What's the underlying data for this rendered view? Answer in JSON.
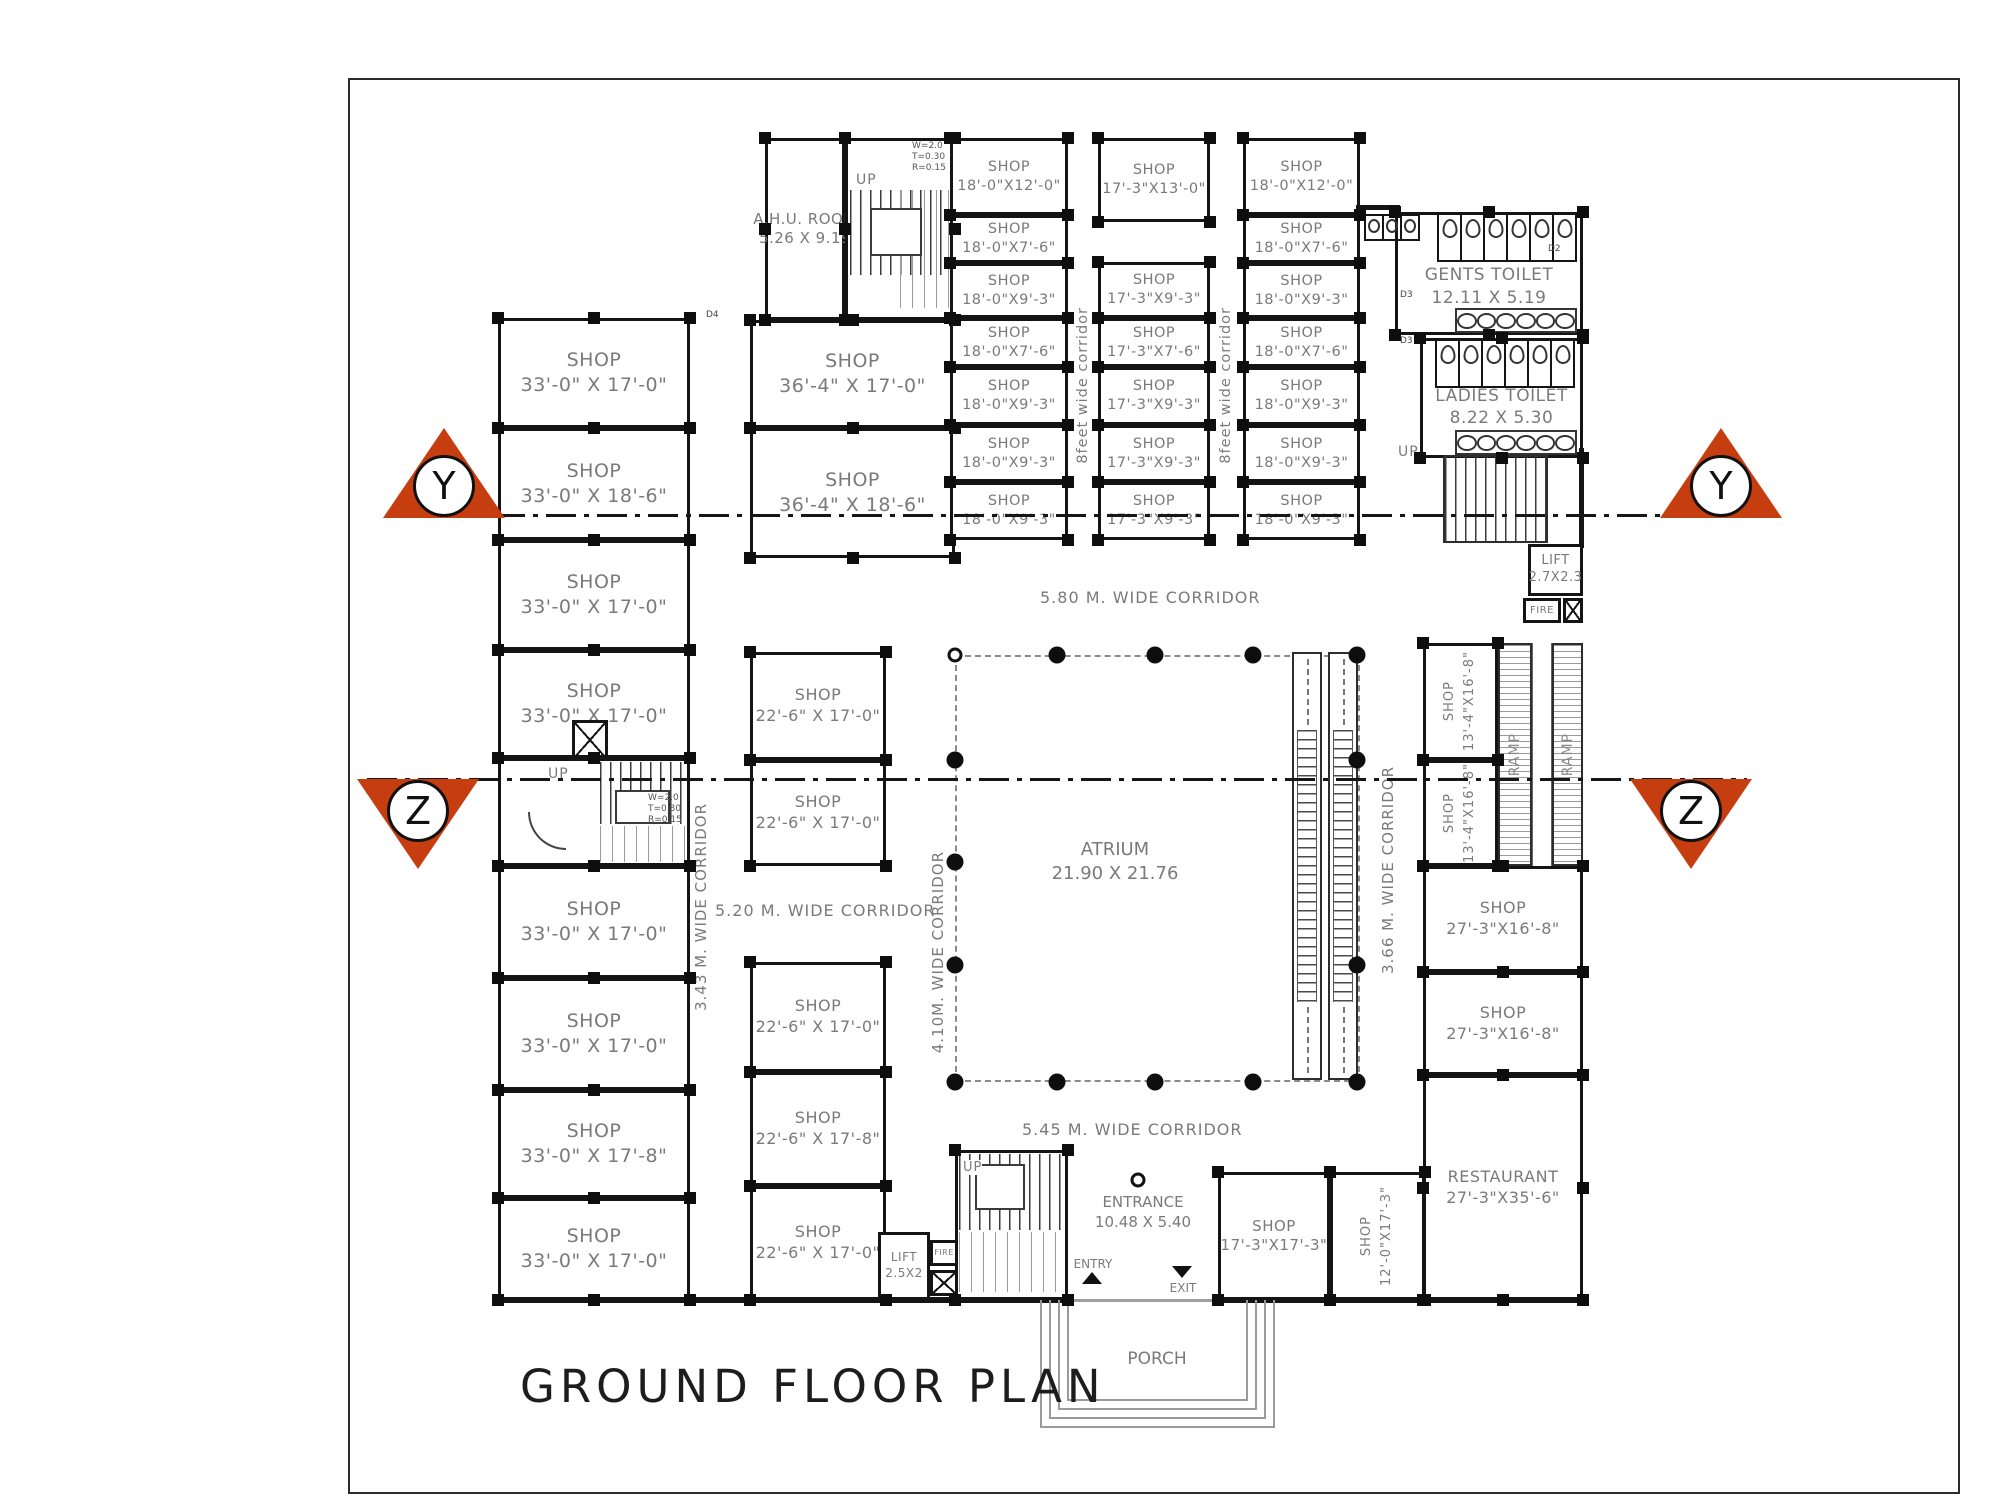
{
  "title": "GROUND FLOOR PLAN",
  "shops": {
    "left": [
      {
        "name": "SHOP",
        "dims": "33'-0\" X 17'-0\""
      },
      {
        "name": "SHOP",
        "dims": "33'-0\" X 18'-6\""
      },
      {
        "name": "SHOP",
        "dims": "33'-0\" X 17'-0\""
      },
      {
        "name": "SHOP",
        "dims": "33'-0\" X 17'-0\""
      },
      {
        "name": "SHOP",
        "dims": "33'-0\" X 17'-0\""
      },
      {
        "name": "SHOP",
        "dims": "33'-0\" X 17'-0\""
      },
      {
        "name": "SHOP",
        "dims": "33'-0\" X 17'-8\""
      },
      {
        "name": "SHOP",
        "dims": "33'-0\" X 17'-0\""
      }
    ],
    "mid22": [
      {
        "name": "SHOP",
        "dims": "22'-6\" X 17'-0\""
      },
      {
        "name": "SHOP",
        "dims": "22'-6\" X 17'-0\""
      },
      {
        "name": "SHOP",
        "dims": "22'-6\" X 17'-0\""
      },
      {
        "name": "SHOP",
        "dims": "22'-6\" X 17'-8\""
      },
      {
        "name": "SHOP",
        "dims": "22'-6\" X 17'-0\""
      }
    ],
    "wide36": [
      {
        "name": "SHOP",
        "dims": "36'-4\" X 17'-0\""
      },
      {
        "name": "SHOP",
        "dims": "36'-4\" X 18'-6\""
      }
    ],
    "col18_left": [
      {
        "name": "SHOP",
        "dims": "18'-0\"X12'-0\""
      },
      {
        "name": "SHOP",
        "dims": "18'-0\"X7'-6\""
      },
      {
        "name": "SHOP",
        "dims": "18'-0\"X9'-3\""
      },
      {
        "name": "SHOP",
        "dims": "18'-0\"X7'-6\""
      },
      {
        "name": "SHOP",
        "dims": "18'-0\"X9'-3\""
      },
      {
        "name": "SHOP",
        "dims": "18'-0\"X9'-3\""
      },
      {
        "name": "SHOP",
        "dims": "18'-0\"X9'-3\""
      }
    ],
    "col17": [
      {
        "name": "SHOP",
        "dims": "17'-3\"X13'-0\""
      },
      {
        "name": "SHOP",
        "dims": "17'-3\"X9'-3\""
      },
      {
        "name": "SHOP",
        "dims": "17'-3\"X7'-6\""
      },
      {
        "name": "SHOP",
        "dims": "17'-3\"X9'-3\""
      },
      {
        "name": "SHOP",
        "dims": "17'-3\"X9'-3\""
      },
      {
        "name": "SHOP",
        "dims": "17'-3\"X9'-3\""
      }
    ],
    "col18_right": [
      {
        "name": "SHOP",
        "dims": "18'-0\"X12'-0\""
      },
      {
        "name": "SHOP",
        "dims": "18'-0\"X7'-6\""
      },
      {
        "name": "SHOP",
        "dims": "18'-0\"X9'-3\""
      },
      {
        "name": "SHOP",
        "dims": "18'-0\"X7'-6\""
      },
      {
        "name": "SHOP",
        "dims": "18'-0\"X9'-3\""
      },
      {
        "name": "SHOP",
        "dims": "18'-0\"X9'-3\""
      },
      {
        "name": "SHOP",
        "dims": "18'-0\"X9'-3\""
      }
    ],
    "right_vertical": [
      {
        "name": "SHOP",
        "dims": "13'-4\"X16'-8\""
      },
      {
        "name": "SHOP",
        "dims": "13'-4\"X16'-8\""
      }
    ],
    "right27": [
      {
        "name": "SHOP",
        "dims": "27'-3\"X16'-8\""
      },
      {
        "name": "SHOP",
        "dims": "27'-3\"X16'-8\""
      }
    ],
    "bottom": [
      {
        "name": "SHOP",
        "dims": "17'-3\"X17'-3\""
      },
      {
        "name": "SHOP",
        "dims": "12'-0\"X17'-3\""
      }
    ]
  },
  "restaurant": {
    "name": "RESTAURANT",
    "dims": "27'-3\"X35'-6\""
  },
  "ahu": {
    "name": "A.H.U. ROOM",
    "dims": "5.26 X 9.19"
  },
  "toilets": {
    "gents": {
      "name": "GENTS TOILET",
      "dims": "12.11 X 5.19"
    },
    "ladies": {
      "name": "LADIES TOILET",
      "dims": "8.22 X 5.30"
    }
  },
  "atrium": {
    "name": "ATRIUM",
    "dims": "21.90 X 21.76",
    "columns": [
      [
        1057,
        655
      ],
      [
        1155,
        655
      ],
      [
        1253,
        655
      ],
      [
        1357,
        655
      ],
      [
        955,
        760
      ],
      [
        955,
        862
      ],
      [
        955,
        965
      ],
      [
        955,
        1082
      ],
      [
        1057,
        1082
      ],
      [
        1155,
        1082
      ],
      [
        1253,
        1082
      ],
      [
        1357,
        1082
      ],
      [
        1357,
        760
      ],
      [
        1357,
        965
      ]
    ],
    "open_columns": [
      [
        955,
        655
      ],
      [
        1138,
        1180
      ]
    ]
  },
  "corridors": {
    "c580": "5.80 M. WIDE CORRIDOR",
    "c545": "5.45 M. WIDE CORRIDOR",
    "c520": "5.20 M. WIDE CORRIDOR",
    "c343": "3.43 M. WIDE CORRIDOR",
    "c410": "4.10M. WIDE CORRIDOR",
    "c366": "3.66 M. WIDE CORRIDOR",
    "c8a": "8feet wide corridor",
    "c8b": "8feet wide corridor"
  },
  "stairs": {
    "up": "UP",
    "note": [
      "W=2.0",
      "T=0.30",
      "R=0.15"
    ]
  },
  "lifts": {
    "right": {
      "name": "LIFT",
      "dims": "2.7X2.3"
    },
    "bottom": {
      "name": "LIFT",
      "dims": "2.5X2"
    },
    "fire": "FIRE"
  },
  "entrance": {
    "name": "ENTRANCE",
    "dims": "10.48 X 5.40",
    "entry": "ENTRY",
    "exit": "EXIT"
  },
  "porch": "PORCH",
  "ramp": "RAMP",
  "markers": {
    "y": "Y",
    "z": "Z"
  },
  "door_tags": {
    "d2": "D2",
    "d3": "D3",
    "d4": "D4"
  }
}
